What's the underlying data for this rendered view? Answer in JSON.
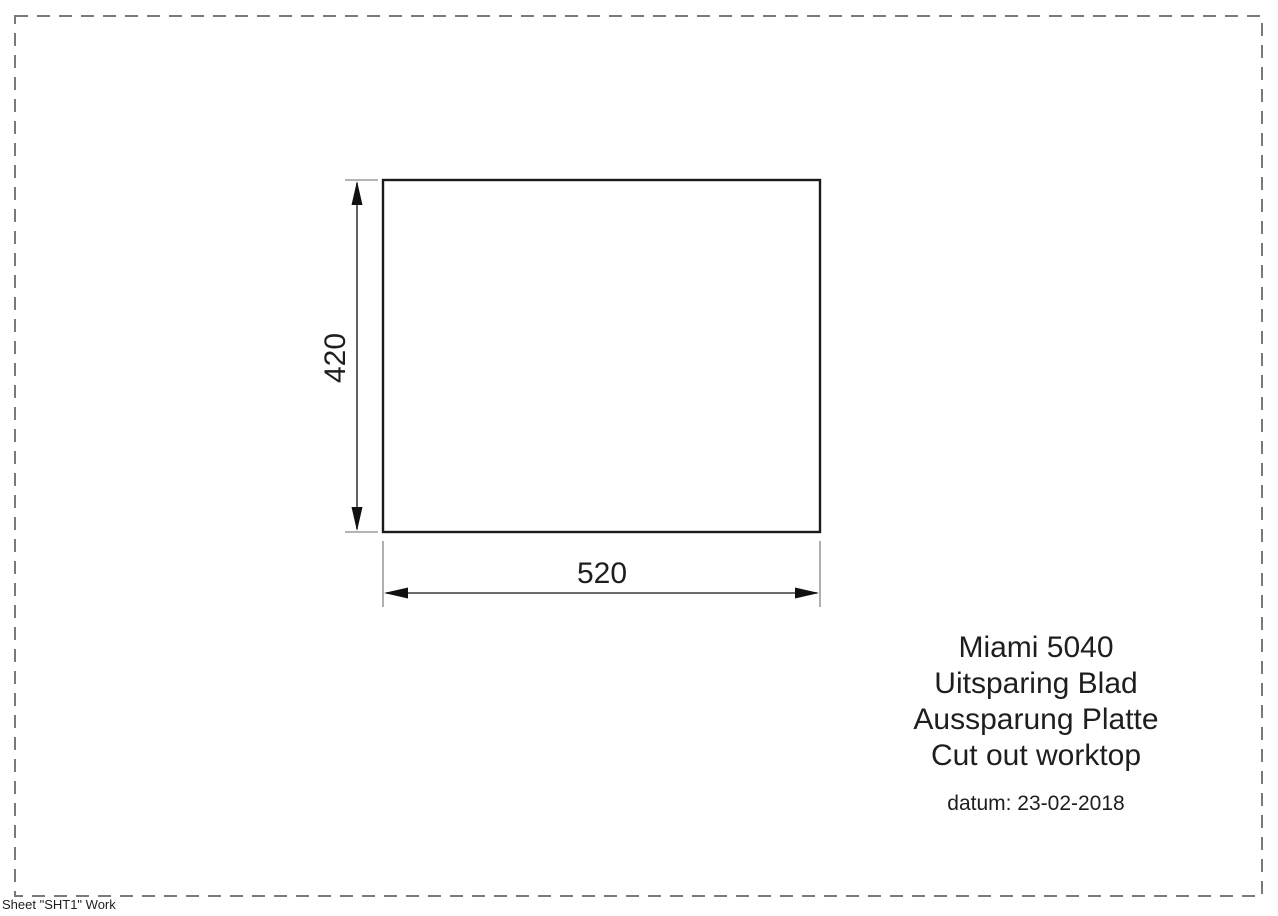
{
  "page": {
    "background": "#ffffff"
  },
  "colors": {
    "sheet_border": "#7a7a7a",
    "outline": "#1b1b1b",
    "dimension": "#3a3a3a",
    "arrow": "#111111",
    "extension": "#9c9c9c",
    "text": "#1e1e1e"
  },
  "drawing": {
    "height_dimension": "420",
    "width_dimension": "520",
    "title_block": {
      "lines": [
        "Miami 5040",
        "Uitsparing Blad",
        "Aussparung Platte",
        "Cut out worktop"
      ],
      "date": "datum: 23-02-2018"
    },
    "sheet_label": "Sheet \"SHT1\" Work"
  }
}
